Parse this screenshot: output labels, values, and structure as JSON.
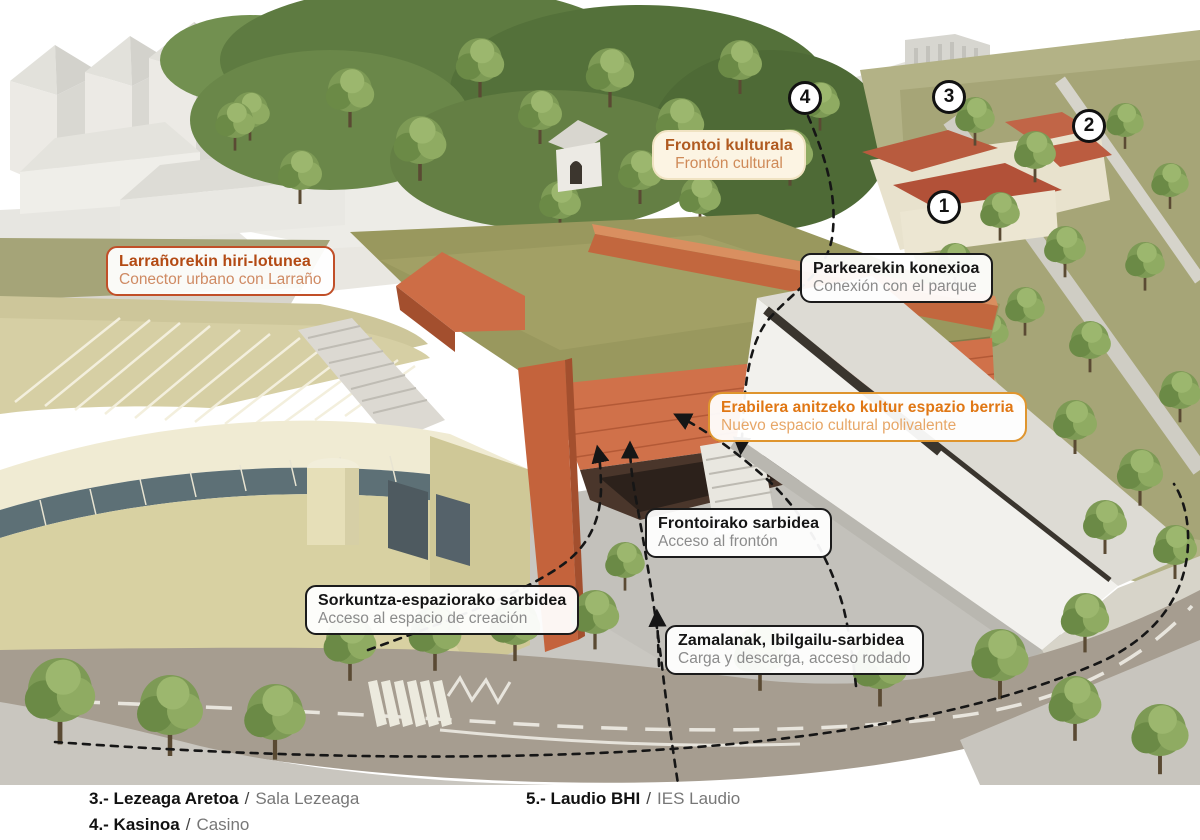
{
  "callouts": [
    {
      "id": "frontoi",
      "title": "Frontoi kulturala",
      "subtitle": "Frontón cultural",
      "variant": "orange-soft"
    },
    {
      "id": "larrano",
      "title": "Larrañorekin hiri-lotunea",
      "subtitle": "Conector urbano con Larraño",
      "variant": "rust-border"
    },
    {
      "id": "parkearekin",
      "title": "Parkearekin konexioa",
      "subtitle": "Conexión con el parque",
      "variant": "black-border"
    },
    {
      "id": "erabilera",
      "title": "Erabilera anitzeko kultur espazio berria",
      "subtitle": "Nuevo espacio cultural polivalente",
      "variant": "amber-border"
    },
    {
      "id": "frontoirako",
      "title": "Frontoirako sarbidea",
      "subtitle": "Acceso al frontón",
      "variant": "black-border"
    },
    {
      "id": "sorkuntza",
      "title": "Sorkuntza-espaziorako sarbidea",
      "subtitle": "Acceso al espacio de creación",
      "variant": "black-border"
    },
    {
      "id": "zamalanak",
      "title": "Zamalanak, Ibilgailu-sarbidea",
      "subtitle": "Carga y descarga, acceso rodado",
      "variant": "black-border"
    }
  ],
  "markers": [
    {
      "number": "1"
    },
    {
      "number": "2"
    },
    {
      "number": "3"
    },
    {
      "number": "4"
    }
  ],
  "legend": [
    {
      "bold": "3.- Lezeaga Aretoa",
      "sep": "/",
      "light": "Sala Lezeaga"
    },
    {
      "bold": "4.- Kasinoa",
      "sep": "/",
      "light": "Casino"
    },
    {
      "bold": "5.- Laudio BHI",
      "sep": "/",
      "light": "IES Laudio"
    }
  ],
  "palette": {
    "accent_orange_building": "#c96a42",
    "rust_border": "#c14f28",
    "amber_border": "#df952e",
    "label_black": "#1b1b1b",
    "label_gray": "#8b8b8b",
    "green_roof": "#99985e",
    "red_tile_roof": "#b85b3e",
    "cream_building": "#d8d1a2",
    "road": "#a69d90"
  }
}
